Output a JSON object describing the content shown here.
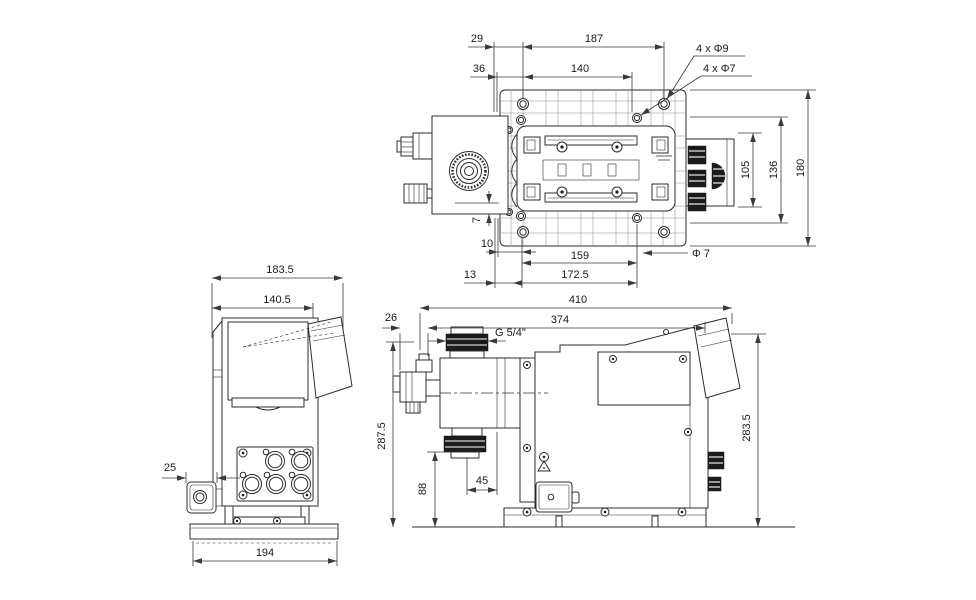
{
  "colors": {
    "background": "#ffffff",
    "object_line": "#2d2d2d",
    "dimension_line": "#3a3a3a",
    "dark_fill": "#1b1b1b"
  },
  "top_view": {
    "dim_29": "29",
    "dim_187": "187",
    "dim_36": "36",
    "dim_140": "140",
    "callout_4x9": "4 x Φ9",
    "callout_4x7": "4 x Φ7",
    "dim_105": "105",
    "dim_136": "136",
    "dim_180": "180",
    "dim_7": "7",
    "dim_10": "10",
    "dim_159": "159",
    "dim_172_5": "172.5",
    "dim_13": "13",
    "callout_dia7": "Φ 7"
  },
  "front_view": {
    "dim_183_5": "183.5",
    "dim_140_5": "140.5",
    "dim_25": "25",
    "dim_194": "194"
  },
  "side_view": {
    "dim_410": "410",
    "dim_374": "374",
    "dim_26": "26",
    "thread_label": "G 5/4\"",
    "dim_287_5": "287.5",
    "dim_88": "88",
    "dim_45": "45",
    "dim_283_5": "283.5"
  }
}
